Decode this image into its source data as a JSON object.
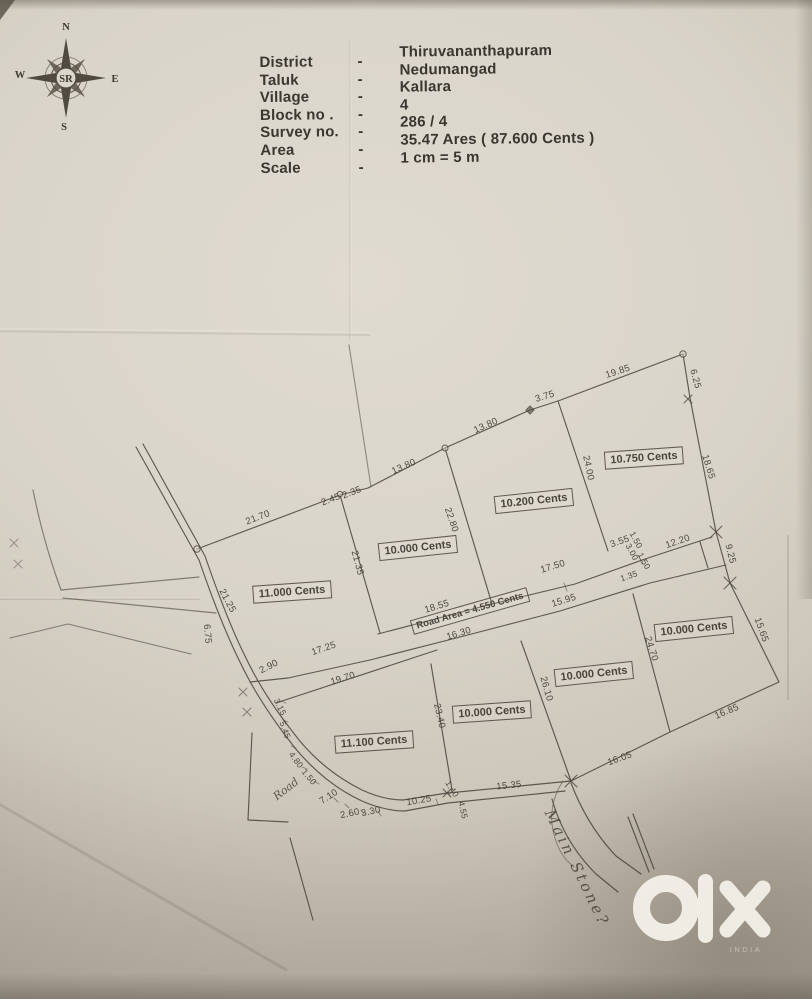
{
  "header": {
    "sep": "-",
    "rows": [
      {
        "label": "District",
        "value": "Thiruvananthapuram"
      },
      {
        "label": "Taluk",
        "value": "Nedumangad"
      },
      {
        "label": "Village",
        "value": "Kallara"
      },
      {
        "label": "Block no .",
        "value": "4"
      },
      {
        "label": "Survey no.",
        "value": "286 / 4"
      },
      {
        "label": "Area",
        "value": "35.47 Ares ( 87.600 Cents )"
      },
      {
        "label": "Scale",
        "value": "1 cm = 5 m"
      }
    ]
  },
  "compass": {
    "north": "N",
    "south": "S",
    "east": "E",
    "west": "W",
    "center": "SR"
  },
  "plot": {
    "parcels": [
      {
        "label": "11.000 Cents"
      },
      {
        "label": "10.000 Cents"
      },
      {
        "label": "10.200 Cents"
      },
      {
        "label": "10.750 Cents"
      },
      {
        "label": "10.000 Cents"
      },
      {
        "label": "10.000 Cents"
      },
      {
        "label": "10.000 Cents"
      },
      {
        "label": "11.100 Cents"
      }
    ],
    "road_area_label": "Road Area = 4.550 Cents",
    "road_name": "Road",
    "handwritten_note": "Main Stone?",
    "dims": [
      {
        "v": "21.70"
      },
      {
        "v": "2.45"
      },
      {
        "v": "2.35"
      },
      {
        "v": "13.80"
      },
      {
        "v": "13.80"
      },
      {
        "v": "3.75"
      },
      {
        "v": "19.85"
      },
      {
        "v": "6.25"
      },
      {
        "v": "18.65"
      },
      {
        "v": "24.00"
      },
      {
        "v": "22.80"
      },
      {
        "v": "21.35"
      },
      {
        "v": "21.25"
      },
      {
        "v": "6.75"
      },
      {
        "v": "3.55"
      },
      {
        "v": "1.50"
      },
      {
        "v": "3.00"
      },
      {
        "v": "1.50"
      },
      {
        "v": "1.35"
      },
      {
        "v": "12.20"
      },
      {
        "v": "9.25"
      },
      {
        "v": "17.50"
      },
      {
        "v": "15.95"
      },
      {
        "v": "18.55"
      },
      {
        "v": "16.30"
      },
      {
        "v": "17.25"
      },
      {
        "v": "2.90"
      },
      {
        "v": "19.70"
      },
      {
        "v": "23.40"
      },
      {
        "v": "26.10"
      },
      {
        "v": "24.70"
      },
      {
        "v": "15.65"
      },
      {
        "v": "16.85"
      },
      {
        "v": "16.05"
      },
      {
        "v": "15.35"
      },
      {
        "v": "1.40"
      },
      {
        "v": "4.55"
      },
      {
        "v": "10.25"
      },
      {
        "v": "3.30"
      },
      {
        "v": "2.60"
      },
      {
        "v": "7.10"
      },
      {
        "v": "1.50"
      },
      {
        "v": "4.80"
      },
      {
        "v": "5.45"
      },
      {
        "v": "3.15"
      }
    ]
  },
  "watermark": {
    "brand": "olx",
    "country": "INDIA"
  },
  "colors": {
    "paper": "#d9d4c9",
    "ink": "#45423a",
    "watermark": "#f2efe8"
  }
}
